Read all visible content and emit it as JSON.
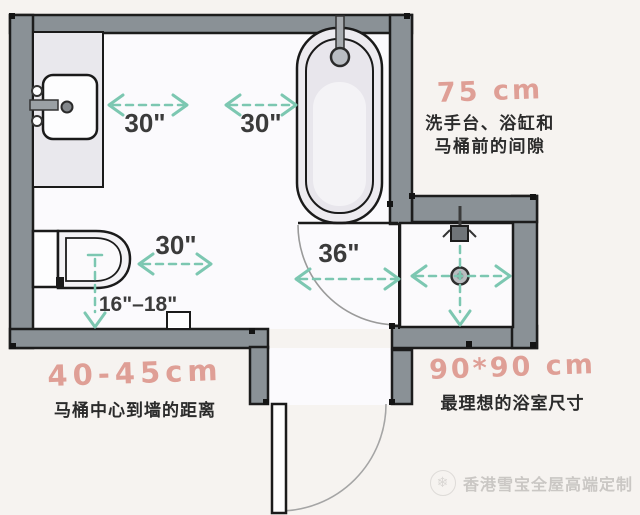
{
  "measurements": {
    "sink_to_tub_left": "30\"",
    "sink_to_tub_right": "30\"",
    "toilet_clearance": "30\"",
    "door_clearance": "36\"",
    "toilet_to_wall": "16\"–18\""
  },
  "annotations": {
    "front_clearance": {
      "value": "75 cm",
      "line1": "洗手台、浴缸和",
      "line2": "马桶前的间隙"
    },
    "toilet_center_distance": {
      "value": "40-45cm",
      "desc": "马桶中心到墙的距离"
    },
    "ideal_shower": {
      "value": "90*90 cm",
      "desc": "最理想的浴室尺寸"
    }
  },
  "watermark": {
    "logo": "snowflake-icon",
    "text": "香港雪宝全屋高端定制"
  },
  "colors": {
    "wall_gray": "#8a9196",
    "dimension_teal": "#7cc7b1",
    "annotation_pink": "#df9f96",
    "text_dark": "#2b2b2b",
    "watermark_gray": "#cac7c4"
  }
}
